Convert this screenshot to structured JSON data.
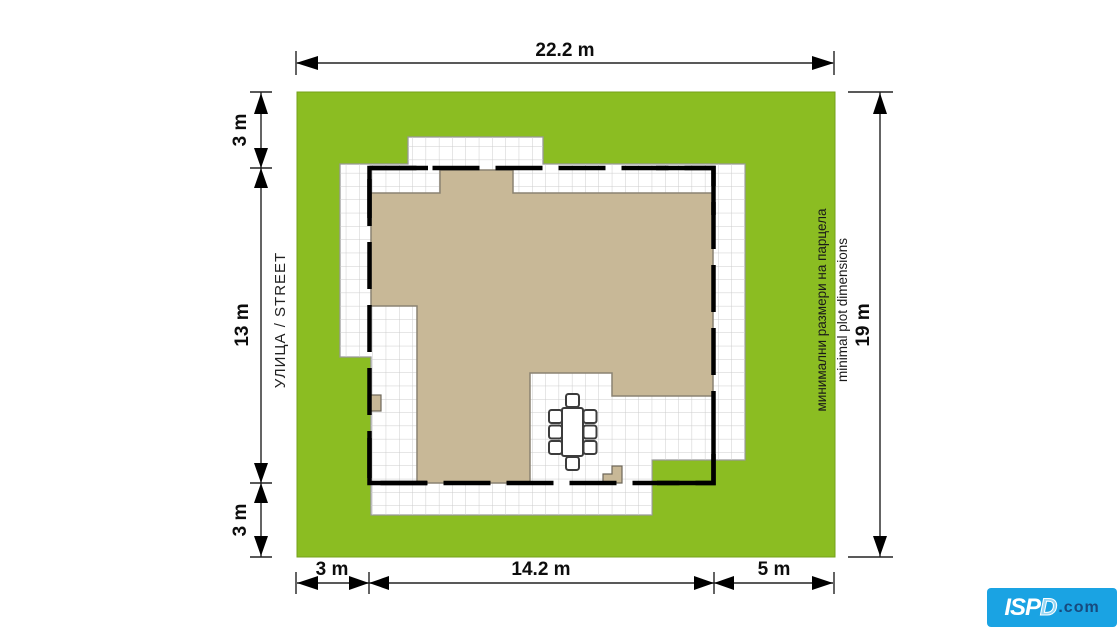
{
  "dimensions": {
    "top": "22.2 m",
    "left_top": "3 m",
    "left_middle": "13 m",
    "left_bottom": "3 m",
    "right": "19 m",
    "bottom_left": "3 m",
    "bottom_middle": "14.2 m",
    "bottom_right": "5 m"
  },
  "labels": {
    "street": "УЛИЦА / STREET",
    "note_bg": "минимални размери на парцела",
    "note_en": "minimal plot dimensions"
  },
  "logo": {
    "name": "ISP",
    "name_outline": "D",
    "suffix": ".com"
  },
  "colors": {
    "grass": "#8bbd22",
    "grass_border": "#76a11b",
    "house": "#c8b897",
    "house_border": "#8a8272",
    "paving": "#ffffff",
    "paving_border": "#999999",
    "grid_line": "#cccccc",
    "wall": "#000000",
    "dimension": "#0d0d0d",
    "logo_bg": "#1aa3e3",
    "logo_text": "#ffffff",
    "logo_suffix": "#174a7e"
  }
}
